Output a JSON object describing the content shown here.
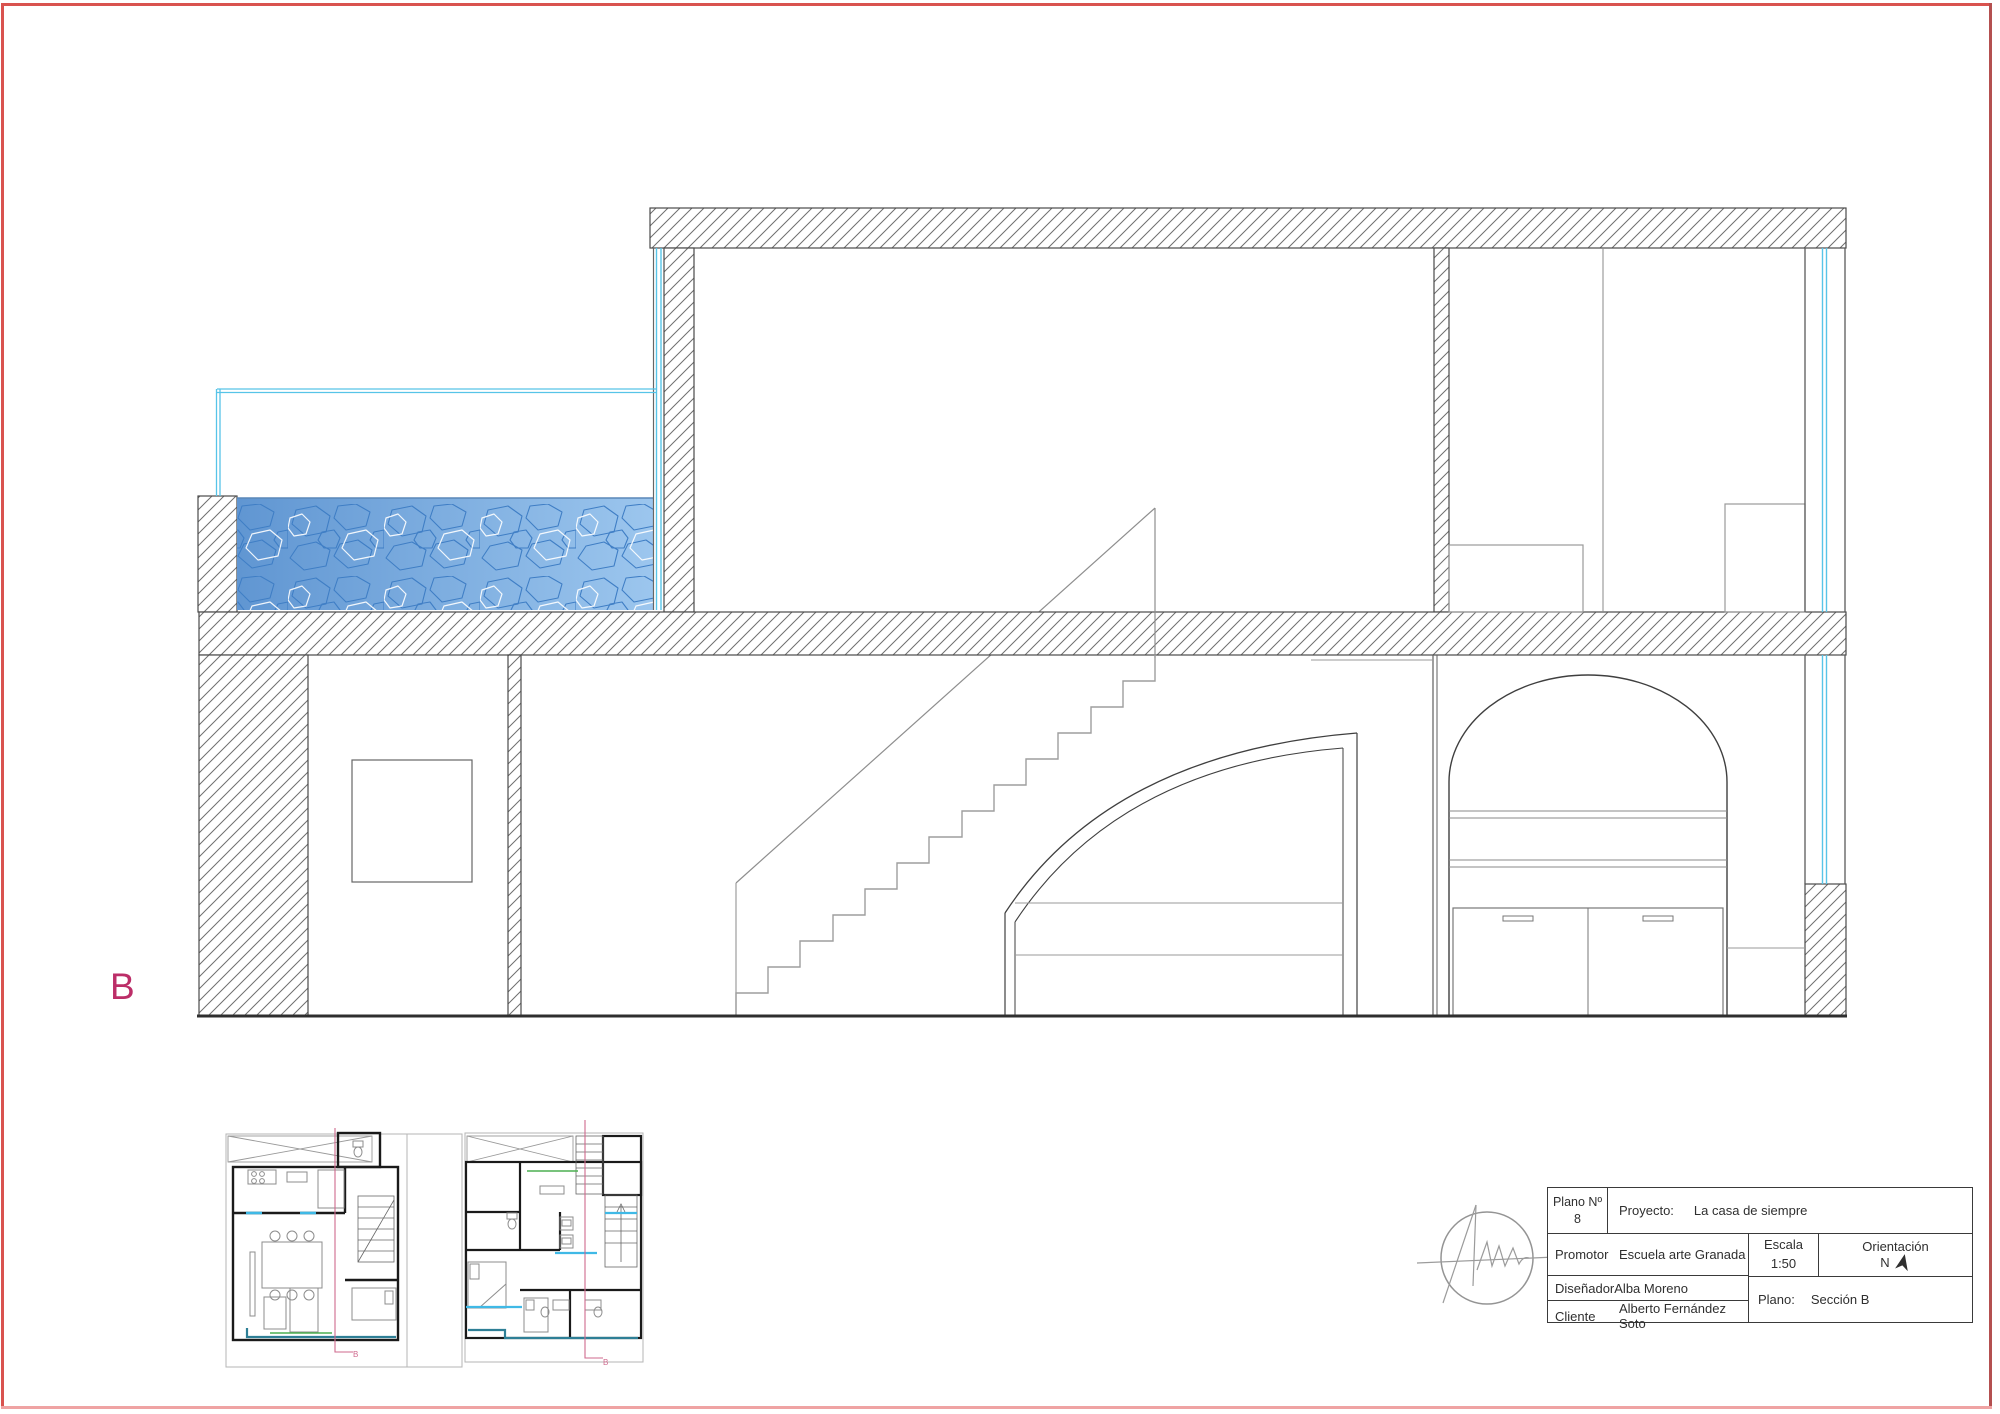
{
  "page": {
    "background": "#ffffff",
    "border_color": "#d9534f",
    "border_bottom_color": "#efa3a3"
  },
  "section": {
    "label": "B",
    "label_color": "#bc2e68",
    "glass_color": "#57c4e8",
    "hatch_color": "#6f6f6f",
    "water": {
      "gradient_left": "#6096d2",
      "gradient_right": "#9cc6ee",
      "cell_stroke": "#3f7ec5",
      "cell_highlight": "#ffffff"
    }
  },
  "plans": {
    "plan1_marker": "B",
    "plan2_marker": "B",
    "section_line_color": "#cf6a8e",
    "accent_cyan": "#3fb9e6",
    "accent_teal": "#2e7f96",
    "accent_green": "#4caf50"
  },
  "title_block": {
    "plano_no_label": "Plano Nº",
    "plano_no_value": "8",
    "proyecto_label": "Proyecto:",
    "proyecto_value": "La casa de siempre",
    "promotor_label": "Promotor",
    "promotor_value": "Escuela arte Granada",
    "disenador_label": "Diseñador",
    "disenador_value": "Alba Moreno",
    "cliente_label": "Cliente",
    "cliente_value": "Alberto Fernández Soto",
    "escala_label": "Escala",
    "escala_value": "1:50",
    "orientacion_label": "Orientación",
    "orientacion_value": "N",
    "plano_label": "Plano:",
    "plano_value": "Sección B"
  }
}
